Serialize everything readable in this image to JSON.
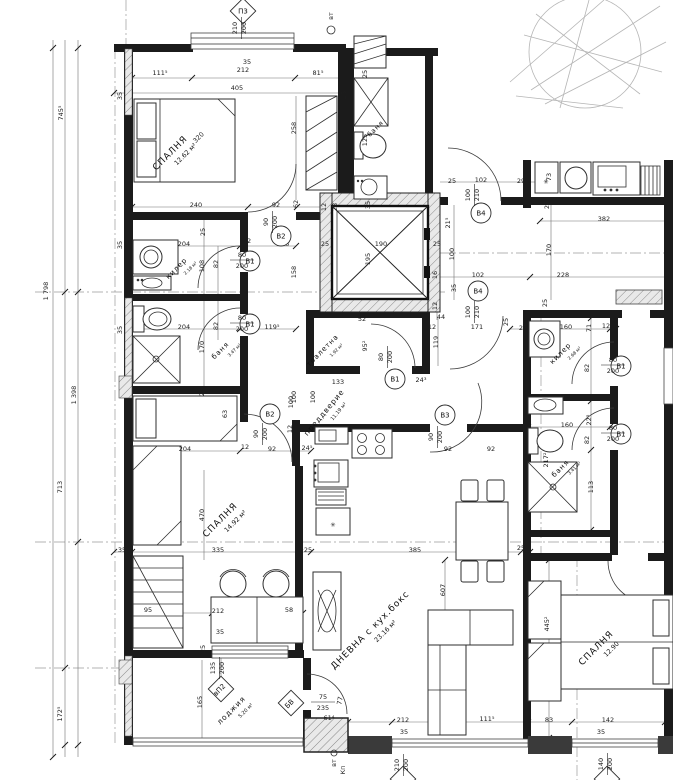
{
  "meta": {
    "drawing_type": "architectural floor plan (apartment level, Bulgarian annotations)",
    "units": "centimeters",
    "accent_color": "#1b1b1b"
  },
  "rooms": [
    {
      "lines": [
        "СПАЛНЯ",
        "12.62 м²"
      ],
      "x": 172,
      "y": 155,
      "r": -45,
      "s": 9
    },
    {
      "lines": [
        "килер",
        "2.18 м²"
      ],
      "x": 178,
      "y": 270,
      "r": -45,
      "s": 7
    },
    {
      "lines": [
        "баня",
        "3.47 м²"
      ],
      "x": 222,
      "y": 352,
      "r": -45,
      "s": 7
    },
    {
      "lines": [
        "баня"
      ],
      "x": 377,
      "y": 130,
      "r": -45,
      "s": 6.5
    },
    {
      "lines": [
        "тоалетна",
        "1.92 м²"
      ],
      "x": 324,
      "y": 352,
      "r": -45,
      "s": 7
    },
    {
      "lines": [
        "преддверие",
        "11.19 м²"
      ],
      "x": 326,
      "y": 414,
      "r": -50,
      "s": 7.5
    },
    {
      "lines": [
        "СПАЛНЯ",
        "14.92 м²"
      ],
      "x": 222,
      "y": 522,
      "r": -45,
      "s": 9
    },
    {
      "lines": [
        "ДНЕВНА с кух.бокс",
        "23.16 м²"
      ],
      "x": 372,
      "y": 632,
      "r": -45,
      "s": 9
    },
    {
      "lines": [
        "лоджия",
        "5.20 м²"
      ],
      "x": 233,
      "y": 712,
      "r": -45,
      "s": 7.5
    },
    {
      "lines": [
        "килер",
        "2.68 м²"
      ],
      "x": 562,
      "y": 355,
      "r": -45,
      "s": 7
    },
    {
      "lines": [
        "баня",
        "3.41 м²"
      ],
      "x": 562,
      "y": 470,
      "r": -45,
      "s": 7
    },
    {
      "lines": [
        "СПАЛНЯ",
        "12.90"
      ],
      "x": 598,
      "y": 650,
      "r": -45,
      "s": 9
    }
  ],
  "door_tags": [
    {
      "id": "В2",
      "w": "90",
      "h": "200",
      "cx": 281,
      "cy": 236,
      "tx": 268,
      "ty": 222,
      "o": "v"
    },
    {
      "id": "В1",
      "w": "80",
      "h": "200",
      "cx": 250,
      "cy": 261,
      "tx": 232,
      "ty": 257,
      "o": "h"
    },
    {
      "id": "В1",
      "w": "80",
      "h": "200",
      "cx": 250,
      "cy": 324,
      "tx": 232,
      "ty": 320,
      "o": "h"
    },
    {
      "id": "В1",
      "w": "80",
      "h": "200",
      "cx": 395,
      "cy": 379,
      "tx": 383,
      "ty": 357,
      "o": "v"
    },
    {
      "id": "В2",
      "w": "90",
      "h": "200",
      "cx": 270,
      "cy": 414,
      "tx": 258,
      "ty": 434,
      "o": "v"
    },
    {
      "id": "В3",
      "w": "90",
      "h": "200",
      "cx": 445,
      "cy": 415,
      "tx": 433,
      "ty": 437,
      "o": "v"
    },
    {
      "id": "В4",
      "w": "100",
      "h": "210",
      "cx": 481,
      "cy": 213,
      "tx": 470,
      "ty": 195,
      "o": "v"
    },
    {
      "id": "В4",
      "w": "100",
      "h": "210",
      "cx": 478,
      "cy": 291,
      "tx": 470,
      "ty": 312,
      "o": "v"
    },
    {
      "id": "В1",
      "w": "80",
      "h": "200",
      "cx": 621,
      "cy": 366,
      "tx": 603,
      "ty": 362,
      "o": "h"
    },
    {
      "id": "В1",
      "w": "80",
      "h": "200",
      "cx": 621,
      "cy": 434,
      "tx": 603,
      "ty": 430,
      "o": "h"
    }
  ],
  "window_tags": [
    {
      "id": "П3",
      "w": "210",
      "h": "200",
      "cx": 243,
      "cy": 11,
      "tx": 237,
      "ty": 28,
      "o": "v",
      "tr": 0
    },
    {
      "id": "вП2",
      "w": "135",
      "h": "200",
      "cx": 221,
      "cy": 689,
      "tx": 215,
      "ty": 668,
      "o": "v",
      "tr": -45
    },
    {
      "id": "БВ",
      "w": "75",
      "h": "235",
      "cx": 291,
      "cy": 703,
      "tx": 313,
      "ty": 699,
      "o": "h",
      "tr": -45
    },
    {
      "id": "",
      "w": "210",
      "h": "200",
      "cx": 403,
      "cy": 779,
      "tx": 399,
      "ty": 765,
      "o": "v",
      "tr": 0
    },
    {
      "id": "",
      "w": "140",
      "h": "200",
      "cx": 607,
      "cy": 779,
      "tx": 603,
      "ty": 764,
      "o": "v",
      "tr": 0
    }
  ],
  "axis_dims": [
    {
      "t": "745⁵",
      "x": 63,
      "y": 113
    },
    {
      "t": "1 798",
      "x": 48,
      "y": 291
    },
    {
      "t": "1 398",
      "x": 76,
      "y": 395
    },
    {
      "t": "713",
      "x": 62,
      "y": 487
    },
    {
      "t": "172⁵",
      "x": 62,
      "y": 714
    }
  ],
  "dims": [
    {
      "t": "35",
      "x": 247,
      "y": 64
    },
    {
      "t": "111⁵",
      "x": 160,
      "y": 75
    },
    {
      "t": "212",
      "x": 243,
      "y": 72
    },
    {
      "t": "81⁵",
      "x": 318,
      "y": 75
    },
    {
      "t": "405",
      "x": 237,
      "y": 90
    },
    {
      "t": "258",
      "x": 296,
      "y": 128,
      "r": -90
    },
    {
      "t": "вт",
      "x": 333,
      "y": 16,
      "r": -90
    },
    {
      "t": "240",
      "x": 196,
      "y": 207
    },
    {
      "t": "92",
      "x": 276,
      "y": 207
    },
    {
      "t": "62",
      "x": 298,
      "y": 204,
      "r": -90
    },
    {
      "t": "35",
      "x": 122,
      "y": 96,
      "r": -90
    },
    {
      "t": "25",
      "x": 205,
      "y": 232,
      "r": -90
    },
    {
      "t": "204",
      "x": 184,
      "y": 246
    },
    {
      "t": "12",
      "x": 247,
      "y": 243
    },
    {
      "t": "146",
      "x": 283,
      "y": 246
    },
    {
      "t": "108",
      "x": 204,
      "y": 266,
      "r": -90
    },
    {
      "t": "82",
      "x": 218,
      "y": 264,
      "r": -90
    },
    {
      "t": "158",
      "x": 296,
      "y": 272,
      "r": -90
    },
    {
      "t": "35",
      "x": 122,
      "y": 245,
      "r": -90
    },
    {
      "t": "204",
      "x": 184,
      "y": 329
    },
    {
      "t": "12",
      "x": 247,
      "y": 326
    },
    {
      "t": "119⁵",
      "x": 272,
      "y": 329
    },
    {
      "t": "82",
      "x": 218,
      "y": 326,
      "r": -90
    },
    {
      "t": "170",
      "x": 204,
      "y": 347,
      "r": -90
    },
    {
      "t": "35",
      "x": 122,
      "y": 330,
      "r": -90
    },
    {
      "t": "25",
      "x": 204,
      "y": 392,
      "r": -90
    },
    {
      "t": "100",
      "x": 296,
      "y": 397,
      "r": -90
    },
    {
      "t": "320",
      "x": 200,
      "y": 139,
      "r": -45
    },
    {
      "t": "12",
      "x": 326,
      "y": 207,
      "r": -90
    },
    {
      "t": "28",
      "x": 337,
      "y": 207,
      "r": -90
    },
    {
      "t": "35",
      "x": 370,
      "y": 205,
      "r": -90
    },
    {
      "t": "25",
      "x": 325,
      "y": 246
    },
    {
      "t": "190",
      "x": 381,
      "y": 246
    },
    {
      "t": "25",
      "x": 437,
      "y": 246
    },
    {
      "t": "195",
      "x": 370,
      "y": 259,
      "r": -90
    },
    {
      "t": "16",
      "x": 437,
      "y": 275,
      "r": -90
    },
    {
      "t": "12",
      "x": 437,
      "y": 306,
      "r": -90
    },
    {
      "t": "25",
      "x": 346,
      "y": 95,
      "r": -90
    },
    {
      "t": "25",
      "x": 367,
      "y": 74,
      "r": -90
    },
    {
      "t": "125",
      "x": 367,
      "y": 140,
      "r": -90
    },
    {
      "t": "28",
      "x": 312,
      "y": 330,
      "r": -90
    },
    {
      "t": "52",
      "x": 362,
      "y": 321
    },
    {
      "t": "95²",
      "x": 367,
      "y": 346,
      "r": -90
    },
    {
      "t": "133",
      "x": 338,
      "y": 384
    },
    {
      "t": "100",
      "x": 315,
      "y": 397,
      "r": -90
    },
    {
      "t": "24³",
      "x": 421,
      "y": 382
    },
    {
      "t": "44",
      "x": 441,
      "y": 319
    },
    {
      "t": "12",
      "x": 432,
      "y": 329
    },
    {
      "t": "171",
      "x": 477,
      "y": 329
    },
    {
      "t": "119",
      "x": 438,
      "y": 342,
      "r": -90
    },
    {
      "t": "102",
      "x": 481,
      "y": 182
    },
    {
      "t": "29",
      "x": 521,
      "y": 183
    },
    {
      "t": "25",
      "x": 452,
      "y": 183
    },
    {
      "t": "21⁵",
      "x": 450,
      "y": 223,
      "r": -90
    },
    {
      "t": "100",
      "x": 454,
      "y": 254,
      "r": -90
    },
    {
      "t": "35",
      "x": 456,
      "y": 288,
      "r": -90
    },
    {
      "t": "102",
      "x": 478,
      "y": 277
    },
    {
      "t": "228",
      "x": 563,
      "y": 277
    },
    {
      "t": "170",
      "x": 551,
      "y": 250,
      "r": -90
    },
    {
      "t": "25",
      "x": 549,
      "y": 205,
      "r": -90
    },
    {
      "t": "382",
      "x": 604,
      "y": 221
    },
    {
      "t": "73",
      "x": 551,
      "y": 177,
      "r": -90
    },
    {
      "t": "25",
      "x": 508,
      "y": 322,
      "r": -90
    },
    {
      "t": "25",
      "x": 523,
      "y": 330
    },
    {
      "t": "160",
      "x": 566,
      "y": 329
    },
    {
      "t": "71",
      "x": 591,
      "y": 328,
      "r": -90
    },
    {
      "t": "12",
      "x": 606,
      "y": 328
    },
    {
      "t": "82",
      "x": 589,
      "y": 368,
      "r": -90
    },
    {
      "t": "25",
      "x": 547,
      "y": 303,
      "r": -90
    },
    {
      "t": "160",
      "x": 567,
      "y": 427
    },
    {
      "t": "22⁵",
      "x": 591,
      "y": 420,
      "r": -90
    },
    {
      "t": "82",
      "x": 589,
      "y": 440,
      "r": -90
    },
    {
      "t": "217²",
      "x": 548,
      "y": 460,
      "r": -90
    },
    {
      "t": "113",
      "x": 593,
      "y": 487,
      "r": -90
    },
    {
      "t": "204",
      "x": 185,
      "y": 451
    },
    {
      "t": "12",
      "x": 245,
      "y": 449
    },
    {
      "t": "92",
      "x": 272,
      "y": 451
    },
    {
      "t": "24⁵",
      "x": 307,
      "y": 450
    },
    {
      "t": "63",
      "x": 227,
      "y": 414,
      "r": -90
    },
    {
      "t": "100",
      "x": 293,
      "y": 402,
      "r": -90
    },
    {
      "t": "12",
      "x": 292,
      "y": 429,
      "r": -90
    },
    {
      "t": "470",
      "x": 204,
      "y": 515,
      "r": -90
    },
    {
      "t": "92",
      "x": 448,
      "y": 451
    },
    {
      "t": "92",
      "x": 491,
      "y": 451
    },
    {
      "t": "35",
      "x": 122,
      "y": 552
    },
    {
      "t": "335",
      "x": 218,
      "y": 552
    },
    {
      "t": "25",
      "x": 308,
      "y": 552
    },
    {
      "t": "385",
      "x": 415,
      "y": 552
    },
    {
      "t": "25",
      "x": 521,
      "y": 550
    },
    {
      "t": "607",
      "x": 445,
      "y": 590,
      "r": -90
    },
    {
      "t": "95",
      "x": 148,
      "y": 612
    },
    {
      "t": "212",
      "x": 218,
      "y": 613
    },
    {
      "t": "58",
      "x": 289,
      "y": 612
    },
    {
      "t": "35",
      "x": 220,
      "y": 634
    },
    {
      "t": "25",
      "x": 205,
      "y": 649,
      "r": -90
    },
    {
      "t": "165",
      "x": 202,
      "y": 702,
      "r": -90
    },
    {
      "t": "61⁴",
      "x": 329,
      "y": 720
    },
    {
      "t": "77",
      "x": 342,
      "y": 701,
      "r": -80
    },
    {
      "t": "445²",
      "x": 549,
      "y": 624,
      "r": -90
    },
    {
      "t": "212",
      "x": 403,
      "y": 722
    },
    {
      "t": "111⁵",
      "x": 487,
      "y": 721
    },
    {
      "t": "83",
      "x": 549,
      "y": 722
    },
    {
      "t": "142",
      "x": 608,
      "y": 722
    },
    {
      "t": "35",
      "x": 404,
      "y": 734
    },
    {
      "t": "35",
      "x": 601,
      "y": 734
    },
    {
      "t": "вт",
      "x": 336,
      "y": 763,
      "r": -90
    },
    {
      "t": "Кп",
      "x": 345,
      "y": 770,
      "r": -90
    }
  ],
  "symbols": [
    {
      "t": "✳",
      "x": 333,
      "y": 527,
      "s": 11
    },
    {
      "t": "✳",
      "x": 546,
      "y": 184,
      "s": 9
    }
  ]
}
